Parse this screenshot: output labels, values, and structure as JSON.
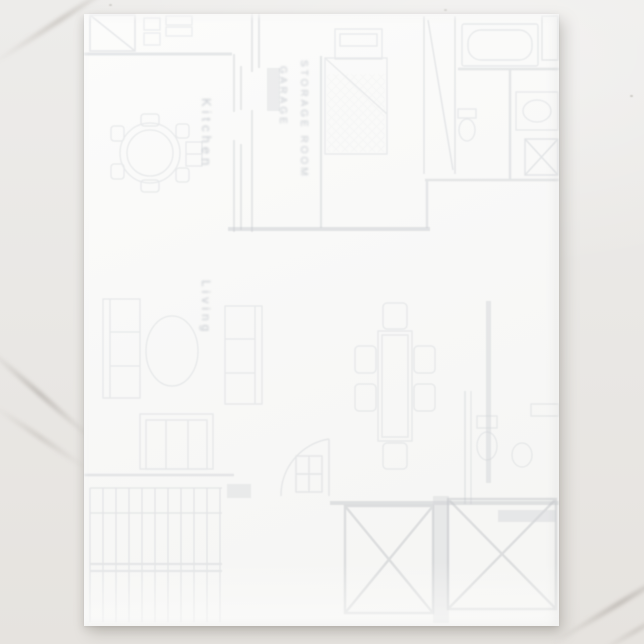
{
  "photo": {
    "subject": "letterhead sheet with faint floor plan print on marble surface"
  },
  "colors": {
    "marble_base": "#e9e7e4",
    "marble_vein": "#b8b3ad",
    "paper": "#f9f9f8",
    "plan_ink": "#bcc1c8",
    "plan_ink_strong": "#a9adb3",
    "label_ink": "#959caa"
  },
  "floorplan": {
    "labels": {
      "kitchen": "Kitchen",
      "garage": "GARAGE",
      "storage": "STORAGE ROOM",
      "living": "Living"
    },
    "features": [
      "closet-diagonal",
      "round-dining-table",
      "bed-with-crosshatch-spread",
      "bathtub",
      "toilet",
      "vanity-sink",
      "shower-x",
      "sofa-pair",
      "oval-coffee-table",
      "loveseat",
      "rectangular-dining-table",
      "entry-door-swing",
      "staircase",
      "deck-x-left",
      "deck-x-right"
    ]
  }
}
